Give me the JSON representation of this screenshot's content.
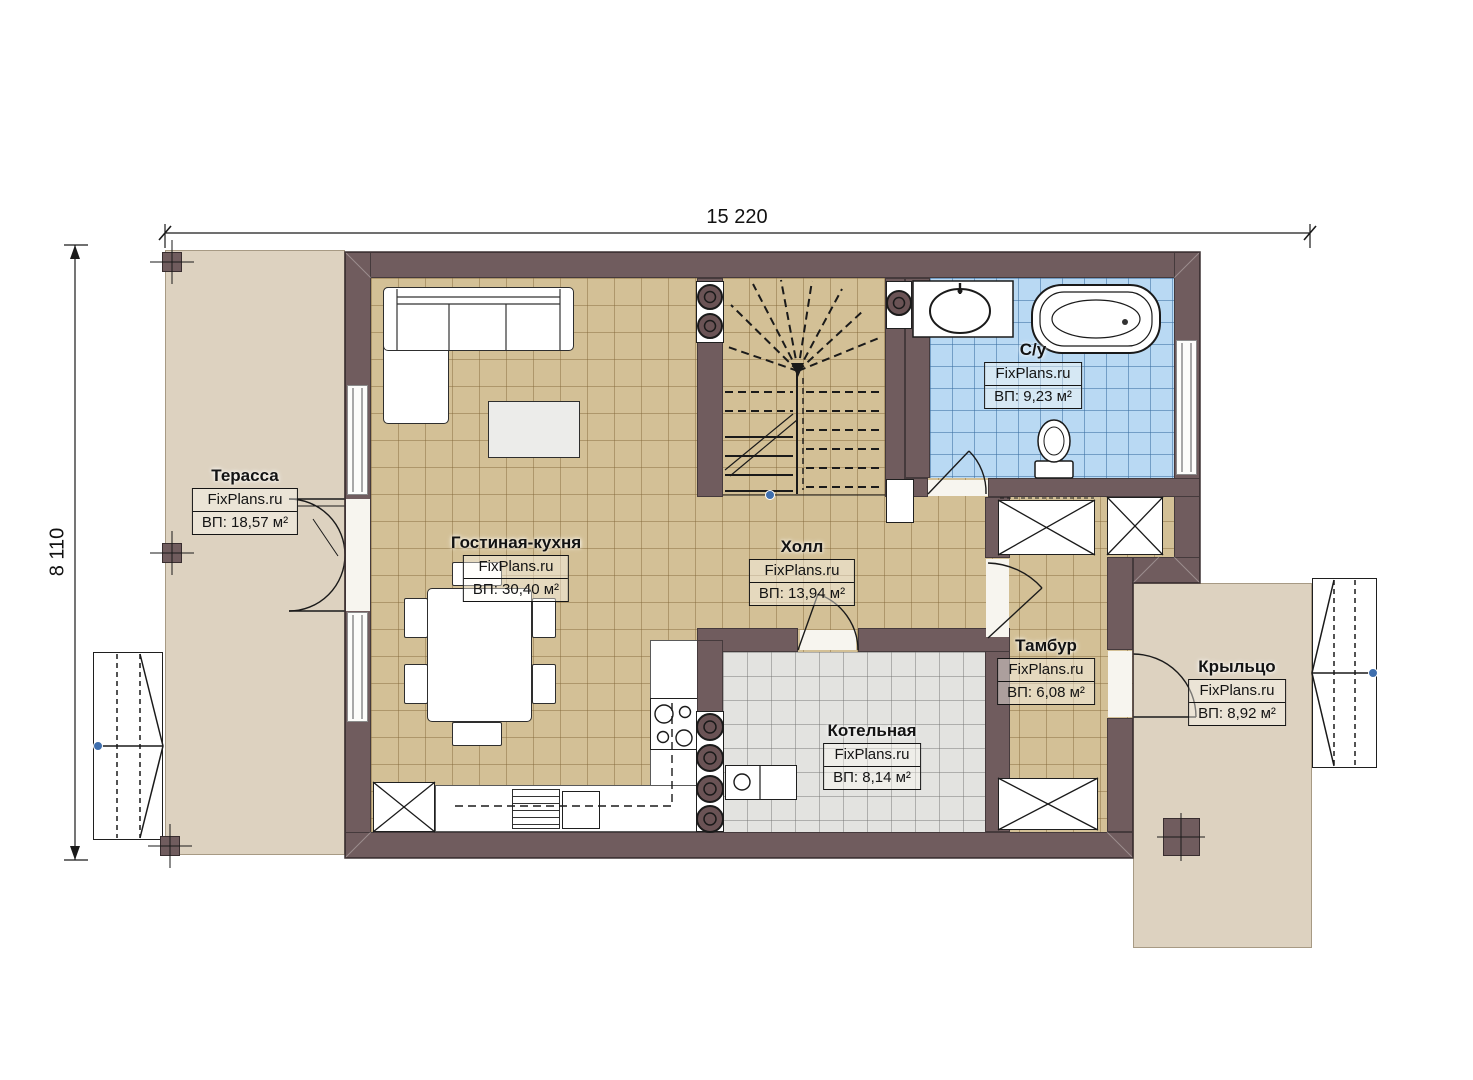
{
  "watermark": "FixPlans.ru",
  "dimensions": {
    "width": "15 220",
    "height": "8 110"
  },
  "rooms": [
    {
      "name": "Терасса",
      "area": "ВП: 18,57 м²"
    },
    {
      "name": "Гостиная-кухня",
      "area": "ВП: 30,40 м²"
    },
    {
      "name": "Холл",
      "area": "ВП: 13,94 м²"
    },
    {
      "name": "С/у",
      "area": "ВП: 9,23 м²"
    },
    {
      "name": "Тамбур",
      "area": "ВП: 6,08 м²"
    },
    {
      "name": "Котельная",
      "area": "ВП: 8,14 м²"
    },
    {
      "name": "Крыльцо",
      "area": "ВП: 8,92 м²"
    }
  ],
  "colors": {
    "wall": "#705c5e",
    "floor_tile": "#d3c096",
    "bath_tile": "#b9d9f3",
    "boiler_tile": "#e3e3e0",
    "outdoor": "#ddd2c0",
    "marker_blue": "#3f6fae"
  }
}
